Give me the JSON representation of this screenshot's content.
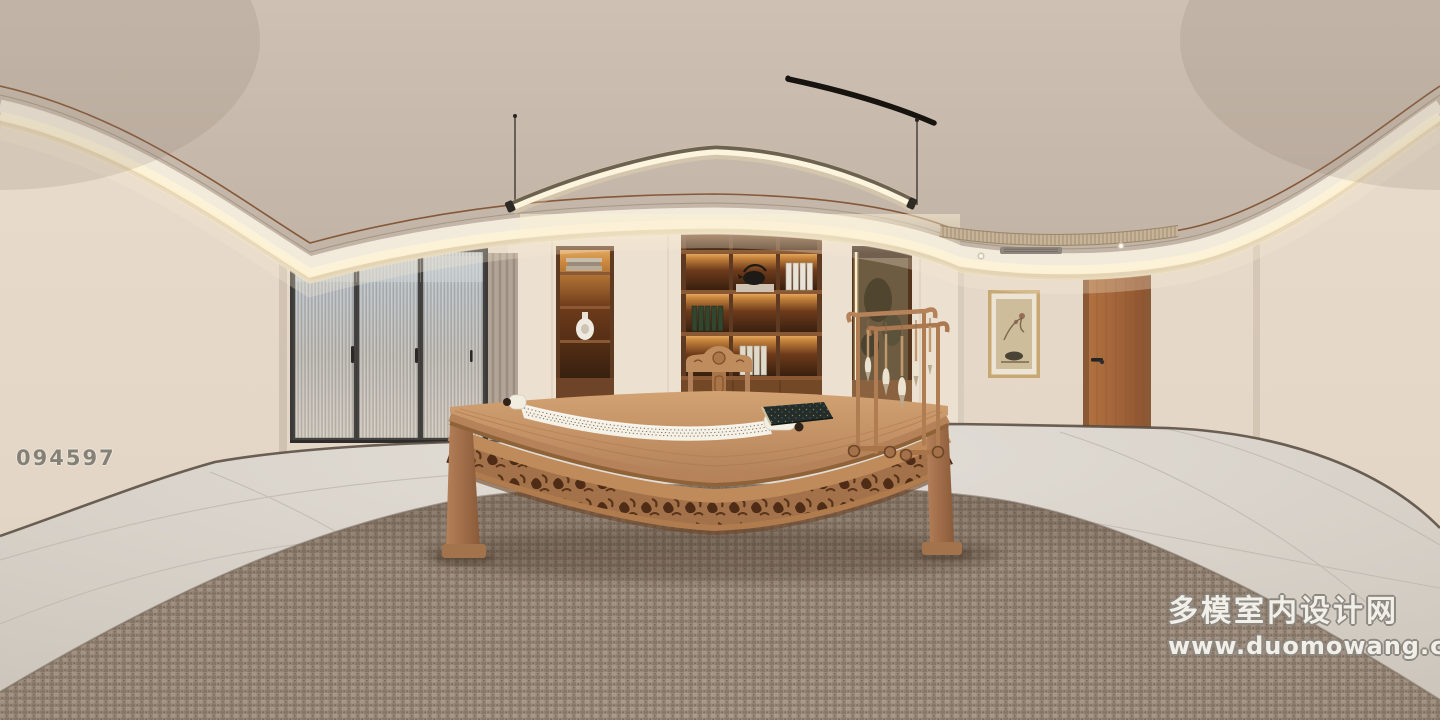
{
  "description": "360-degree equirectangular render of a Chinese-style study: curved cove-lit ceiling, fluted-glass sliding doors, backlit walnut bookshelf, calligraphy scroll on a carved wooden desk, brush stand, woven rug, wooden door and framed ink painting",
  "watermarks": {
    "scene_id": "094597",
    "brand_cn": "多模室内设计网",
    "brand_url": "www.duomowang.com"
  },
  "palette": {
    "wall": "#e7dacb",
    "ceiling": "#cabcae",
    "cove_glow": "#fbf0d2",
    "cornice_trim": "#7d4e2c",
    "shelf_wood": "#5f3a22",
    "shelf_glow": "#d79a52",
    "desk_wood": "#c08b5b",
    "floor_tile": "#ddd8d1",
    "rug": "#9c8c7e",
    "door_wood": "#a8693c",
    "fluted_glass": "#b4babe",
    "scroll_paper": "#f5f1e7"
  },
  "objects": [
    "pendant-linear-light",
    "curved-track-arm",
    "cove-light",
    "sliding-glass-doors",
    "curtain",
    "niche-shelf",
    "bookshelf",
    "hanging-scroll-painting",
    "wall-painting",
    "wooden-door",
    "calligraphy-desk",
    "scroll",
    "brush-stand",
    "ink-book",
    "armchair",
    "woven-rug",
    "tile-floor"
  ]
}
